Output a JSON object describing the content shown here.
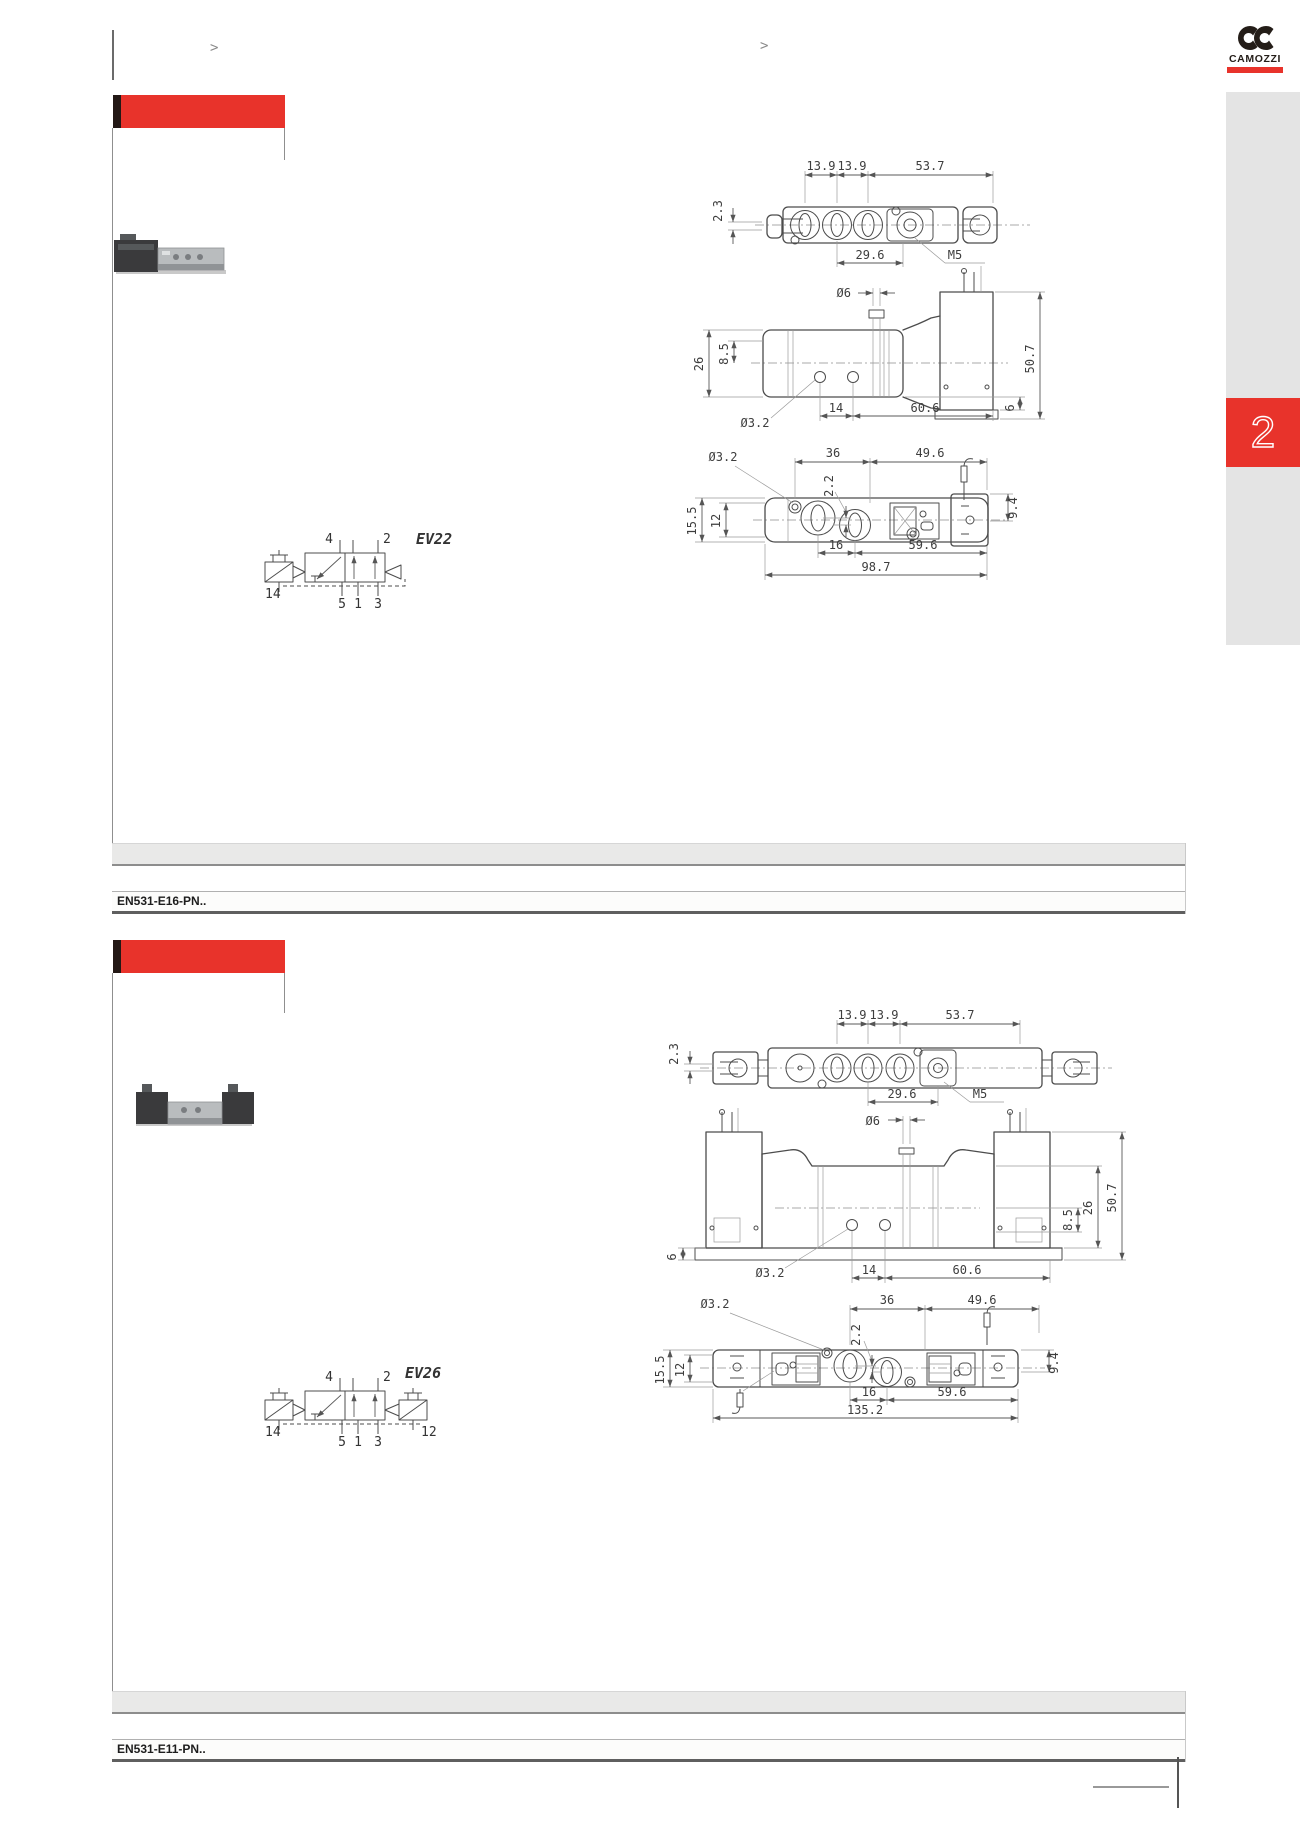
{
  "page": {
    "breadcrumbs": [
      ">",
      ">"
    ],
    "logo": {
      "brand": "CAMOZZI",
      "mark": "camozzi-ck-mark"
    },
    "side_tab": {
      "number": "2"
    },
    "colors": {
      "accent_red": "#e8332b",
      "header_edge": "#231815",
      "sidebar_gray": "#e4e4e4",
      "table_gray": "#e9e9e8"
    }
  },
  "sections": [
    {
      "code": "EN531-E16-PN..",
      "symbol": {
        "label": "EV22",
        "p14": "14",
        "p4": "4",
        "p2": "2",
        "p5": "5",
        "p1": "1",
        "p3": "3"
      },
      "top_view": {
        "h": "2.3",
        "w1": "13.9",
        "w2": "13.9",
        "w3": "53.7",
        "b": "29.6",
        "thread": "M5"
      },
      "side_view": {
        "dia6": "Ø6",
        "v26": "26",
        "v85": "8.5",
        "dia32": "Ø3.2",
        "w14": "14",
        "w606": "60.6",
        "h6": "6",
        "h507": "50.7"
      },
      "bottom_view": {
        "dia32": "Ø3.2",
        "w36": "36",
        "w496": "49.6",
        "g22": "2.2",
        "h155": "15.5",
        "h12": "12",
        "w16": "16",
        "w596": "59.6",
        "total": "98.7",
        "h94": "9.4"
      }
    },
    {
      "code": "EN531-E11-PN..",
      "symbol": {
        "label": "EV26",
        "p14": "14",
        "p4": "4",
        "p2": "2",
        "p5": "5",
        "p1": "1",
        "p3": "3",
        "p12": "12"
      },
      "top_view": {
        "h": "2.3",
        "w1": "13.9",
        "w2": "13.9",
        "w3": "53.7",
        "b": "29.6",
        "thread": "M5"
      },
      "front_view": {
        "dia6": "Ø6",
        "h6": "6",
        "dia32": "Ø3.2",
        "w14": "14",
        "w606": "60.6",
        "v85": "8.5",
        "v26": "26",
        "h507": "50.7"
      },
      "bottom_view": {
        "dia32": "Ø3.2",
        "w36": "36",
        "w496": "49.6",
        "g22": "2.2",
        "h155": "15.5",
        "h12": "12",
        "w16": "16",
        "w596": "59.6",
        "total": "135.2",
        "h94": "9.4"
      }
    }
  ]
}
